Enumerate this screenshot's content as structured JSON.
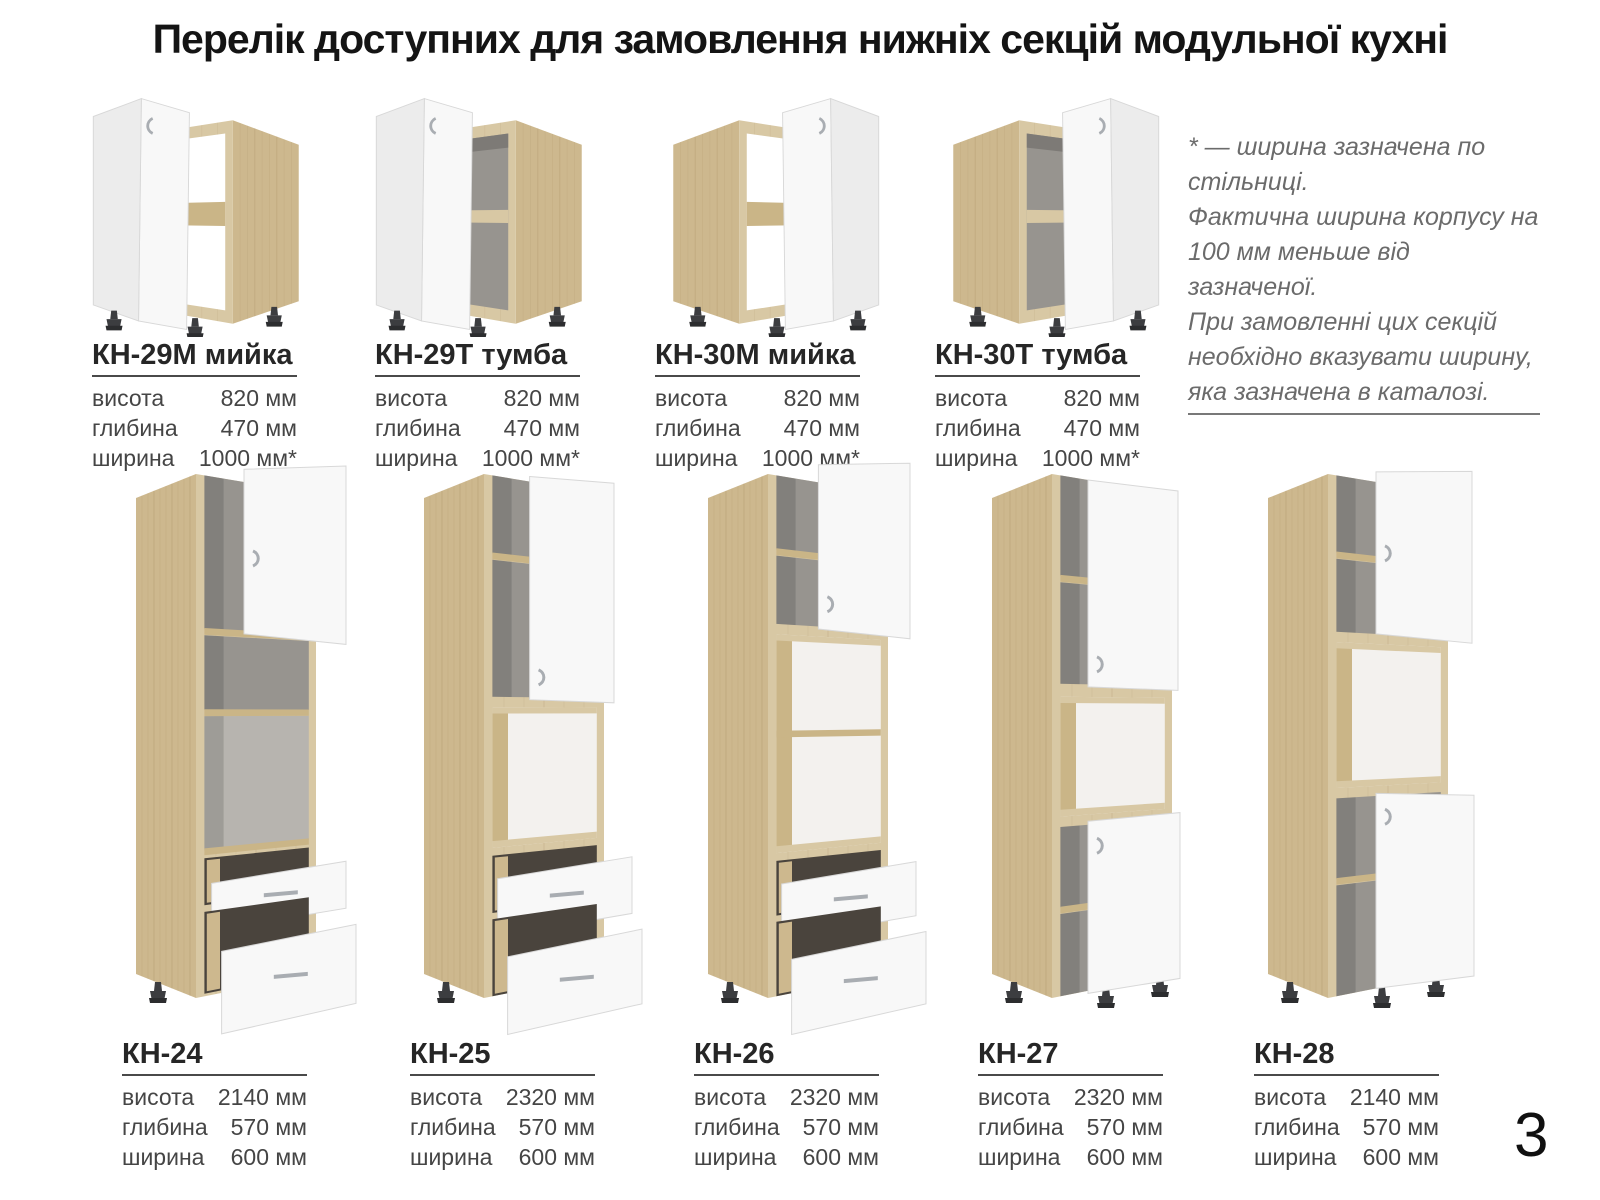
{
  "title": "Перелік доступних для замовлення нижніх секцій модульної кухні",
  "page_number": "3",
  "note": {
    "line1": "* — ширина зазначена по стільниці.",
    "line2": "Фактична ширина корпусу на 100 мм меньше від зазначеної.",
    "line3": "При замовленні цих секцій необхідно вказувати ширину, яка зазначена в каталозі."
  },
  "spec_field_labels": {
    "height": "висота",
    "depth": "глибина",
    "width": "ширина"
  },
  "top_row_cabinets": [
    {
      "model": "КН-29М мийка",
      "height": "820 мм",
      "depth": "470 мм",
      "width": "1000 мм*"
    },
    {
      "model": "КН-29Т тумба",
      "height": "820 мм",
      "depth": "470 мм",
      "width": "1000 мм*"
    },
    {
      "model": "КН-30М мийка",
      "height": "820 мм",
      "depth": "470 мм",
      "width": "1000 мм*"
    },
    {
      "model": "КН-30Т тумба",
      "height": "820 мм",
      "depth": "470 мм",
      "width": "1000 мм*"
    }
  ],
  "tall_cabinets": [
    {
      "model": "КН-24",
      "height": "2140 мм",
      "depth": "570 мм",
      "width": "600 мм"
    },
    {
      "model": "КН-25",
      "height": "2320 мм",
      "depth": "570 мм",
      "width": "600 мм"
    },
    {
      "model": "КН-26",
      "height": "2320 мм",
      "depth": "570 мм",
      "width": "600 мм"
    },
    {
      "model": "КН-27",
      "height": "2320 мм",
      "depth": "570 мм",
      "width": "600 мм"
    },
    {
      "model": "КН-28",
      "height": "2140 мм",
      "depth": "570 мм",
      "width": "600 мм"
    }
  ],
  "colors": {
    "wood_front": "#d8c8a4",
    "wood_side": "#cdb88e",
    "wood_rail": "#cab587",
    "door_white": "#f8f8f8",
    "door_shade": "#ececec",
    "door_edge": "#d8d8d8",
    "interior_gray": "#97948f",
    "interior_light": "#b7b4af",
    "niche_back": "#f3f1ee",
    "drawer_slot": "#4a443d",
    "feet": "#3c3d40",
    "handle": "#a9adb2",
    "text_dark": "#262626",
    "text_gray": "#454545",
    "note_gray": "#6b6b6b"
  }
}
